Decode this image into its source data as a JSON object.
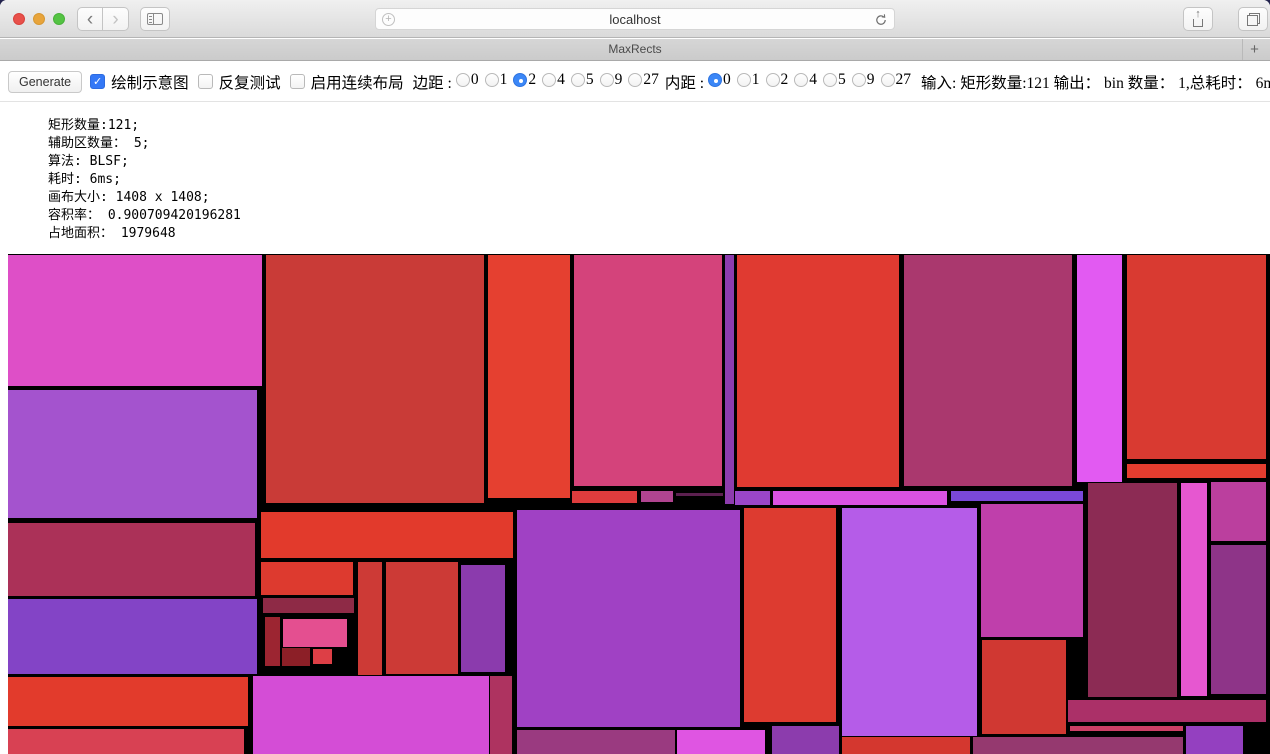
{
  "browser": {
    "url": "localhost",
    "tab_title": "MaxRects",
    "new_tab_label": "+",
    "icons": {
      "back": "‹",
      "forward": "›",
      "share_arrow": "↑",
      "url_badge": "+",
      "traffic_close": "#e8504a",
      "traffic_min": "#e8a43b",
      "traffic_zoom": "#54c343"
    }
  },
  "toolbar": {
    "generate_label": "Generate",
    "checkboxes": [
      {
        "label": "绘制示意图",
        "checked": true
      },
      {
        "label": "反复测试",
        "checked": false
      },
      {
        "label": "启用连续布局",
        "checked": false
      }
    ],
    "margin": {
      "label": "边距 :",
      "options": [
        "0",
        "1",
        "2",
        "4",
        "5",
        "9",
        "27"
      ],
      "selected": "2"
    },
    "padding": {
      "label": "内距 :",
      "options": [
        "0",
        "1",
        "2",
        "4",
        "5",
        "9",
        "27"
      ],
      "selected": "0"
    },
    "io_summary": "输入: 矩形数量:121 输出： bin 数量： 1,总耗时： 6ms",
    "accent_blue": "#3b87f7"
  },
  "stats": {
    "lines": [
      "矩形数量:121;",
      "辅助区数量： 5;",
      "算法: BLSF;",
      "耗时: 6ms;",
      "画布大小: 1408 x 1408;",
      "容积率： 0.900709420196281",
      "占地面积： 1979648"
    ]
  },
  "canvas": {
    "background": "#000000",
    "rects": [
      [
        0,
        1,
        254,
        131,
        "#de4fc7"
      ],
      [
        0,
        136,
        249,
        128,
        "#a453ce"
      ],
      [
        0,
        269,
        247,
        73,
        "#ab3158"
      ],
      [
        0,
        345,
        249,
        75,
        "#8344c6"
      ],
      [
        0,
        423,
        240,
        49,
        "#e23b2c"
      ],
      [
        0,
        475,
        236,
        25,
        "#d84153"
      ],
      [
        258,
        1,
        218,
        248,
        "#c93b37"
      ],
      [
        480,
        1,
        82,
        243,
        "#e54030"
      ],
      [
        566,
        1,
        148,
        231,
        "#d4437b"
      ],
      [
        717,
        1,
        9,
        249,
        "#8d3cae"
      ],
      [
        729,
        1,
        162,
        232,
        "#e03a31"
      ],
      [
        896,
        1,
        168,
        231,
        "#aa386e"
      ],
      [
        1069,
        1,
        45,
        227,
        "#e25af2"
      ],
      [
        1119,
        1,
        139,
        204,
        "#d93a31"
      ],
      [
        1119,
        210,
        139,
        14,
        "#e33d2f"
      ],
      [
        564,
        237,
        65,
        12,
        "#de3c3d"
      ],
      [
        633,
        237,
        32,
        11,
        "#b04490"
      ],
      [
        668,
        239,
        47,
        3,
        "#5c2050"
      ],
      [
        727,
        237,
        35,
        14,
        "#9a46c8"
      ],
      [
        765,
        237,
        174,
        14,
        "#da52e2"
      ],
      [
        943,
        237,
        132,
        10,
        "#7a48d8"
      ],
      [
        253,
        258,
        252,
        46,
        "#e23a2c"
      ],
      [
        253,
        308,
        92,
        33,
        "#dd3a2f"
      ],
      [
        255,
        344,
        91,
        15,
        "#8e2a46"
      ],
      [
        257,
        363,
        15,
        49,
        "#9c2531"
      ],
      [
        275,
        365,
        64,
        28,
        "#e44f90"
      ],
      [
        274,
        394,
        28,
        18,
        "#8c1f27"
      ],
      [
        305,
        395,
        19,
        15,
        "#dd3f46"
      ],
      [
        350,
        308,
        24,
        113,
        "#cd3a36"
      ],
      [
        378,
        308,
        72,
        112,
        "#cc3a36"
      ],
      [
        453,
        311,
        44,
        107,
        "#8b3bad"
      ],
      [
        509,
        256,
        223,
        217,
        "#a041c4"
      ],
      [
        736,
        254,
        92,
        214,
        "#dd3b30"
      ],
      [
        834,
        254,
        135,
        228,
        "#b55ce8"
      ],
      [
        973,
        250,
        102,
        133,
        "#bf3fab"
      ],
      [
        1080,
        229,
        89,
        214,
        "#8c2b54"
      ],
      [
        1173,
        229,
        26,
        213,
        "#e657d0"
      ],
      [
        1203,
        228,
        55,
        59,
        "#bb3f9e"
      ],
      [
        1203,
        291,
        55,
        149,
        "#8e3488"
      ],
      [
        245,
        422,
        236,
        78,
        "#d44dd6"
      ],
      [
        482,
        422,
        22,
        78,
        "#ae3360"
      ],
      [
        509,
        476,
        158,
        24,
        "#9a3a80"
      ],
      [
        669,
        476,
        88,
        24,
        "#df55e2"
      ],
      [
        764,
        472,
        67,
        28,
        "#8c3cad"
      ],
      [
        834,
        483,
        128,
        17,
        "#d4372f"
      ],
      [
        965,
        483,
        210,
        17,
        "#95396f"
      ],
      [
        974,
        386,
        84,
        94,
        "#d03832"
      ],
      [
        1060,
        446,
        198,
        22,
        "#ab3068"
      ],
      [
        1062,
        472,
        113,
        5,
        "#cc3f66"
      ],
      [
        1178,
        472,
        57,
        28,
        "#9440c0"
      ]
    ]
  }
}
